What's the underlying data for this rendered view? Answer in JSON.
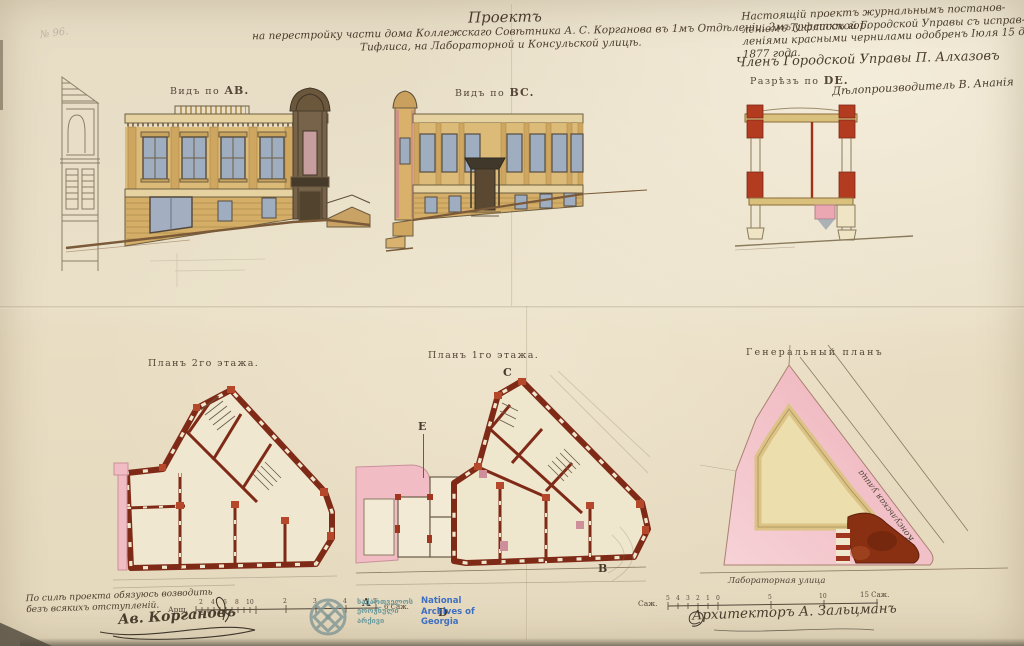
{
  "archive_note": "№ 96.",
  "title": {
    "heading": "Проектъ",
    "line1": "на перестройку части дома Коллежскаго Совѣтника А. С. Корганова въ 1мъ Отдѣленіи, 2мъ участкѣ гор.",
    "line2": "Тифлиса, на Лабораторной и Консульской улицѣ."
  },
  "approval": {
    "lines": [
      "Настоящій проектъ журнальнымъ постанов-",
      "леніемъ Тифлисской Городской Управы съ исправ-",
      "леніями красными чернилами одобренъ Іюля 15 дня",
      "1877 года."
    ],
    "member": "Членъ Городской Управы П. Алхазовъ",
    "clerk": "Дѣлопроизводитель В. Ананія"
  },
  "labels": {
    "view_ab": {
      "prefix": "Видъ по",
      "key": "AB."
    },
    "view_bc": {
      "prefix": "Видъ по",
      "key": "BC."
    },
    "section_de": {
      "prefix": "Разрѣзъ по",
      "key": "DE."
    },
    "plan2": "Планъ 2го этажа.",
    "plan1": "Планъ 1го этажа.",
    "site": "Генеральный планъ"
  },
  "streets": {
    "diagonal": "Консульская улица",
    "bottom": "Лабораторная улица"
  },
  "markers": {
    "a": "A",
    "b": "B",
    "c": "C",
    "d": "D",
    "e": "E"
  },
  "scale_left": {
    "unit": "Арш.",
    "dense": [
      "2",
      "4",
      "6",
      "8",
      "10"
    ],
    "sparse": [
      "2",
      "3",
      "4",
      "5"
    ],
    "end": "6 Саж."
  },
  "scale_right": {
    "unit": "Саж.",
    "dense": [
      "5",
      "4",
      "3",
      "2",
      "1",
      "0"
    ],
    "sparse": [
      "5",
      "10"
    ],
    "end": "15 Саж."
  },
  "owner_note": {
    "line1": "По силѣ проекта обязуюсь возводить",
    "line2": "безъ всякихъ отступленій.",
    "signature": "Ав. Коргановъ"
  },
  "architect": "Архитекторъ А. Зальцманъ",
  "watermark": {
    "georgian": [
      "საქართველოს",
      "ეროვნული",
      "არქივი"
    ],
    "english": [
      "National",
      "Archives of",
      "Georgia"
    ]
  },
  "colors": {
    "paper": "#e8dfc9",
    "ink": "#55483a",
    "facade_tan": "#dcba78",
    "wall_red": "#7e2a17",
    "bright_red": "#b5472a",
    "pink": "#f2bcc4",
    "courtyard_cream": "#ecdead",
    "watermark_teal": "#7e9594",
    "watermark_blue": "#3f6fc0"
  }
}
